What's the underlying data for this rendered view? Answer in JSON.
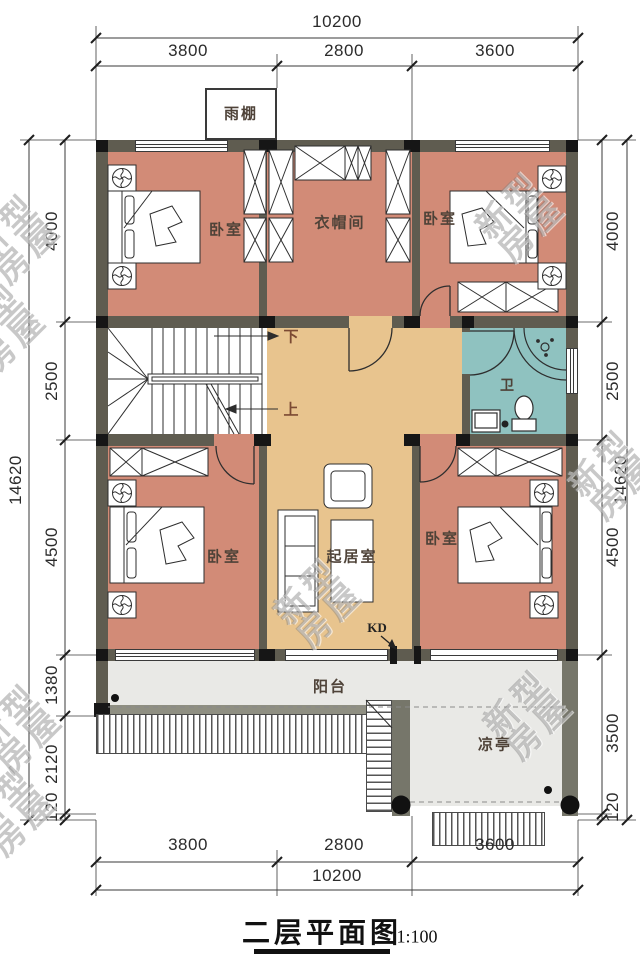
{
  "title": {
    "main": "二层平面图",
    "scale": "1:100"
  },
  "watermark": {
    "line1": "新型",
    "line2": "房屋"
  },
  "labels": {
    "canopy": "雨棚",
    "bedroom_top_left": "卧室",
    "cloakroom": "衣帽间",
    "bedroom_top_right": "卧室",
    "bathroom": "卫",
    "living_room": "起居室",
    "bedroom_bottom_left": "卧室",
    "bedroom_bottom_right": "卧室",
    "balcony": "阳台",
    "pavilion": "凉亭",
    "stair_down": "下",
    "stair_up": "上",
    "kd": "KD"
  },
  "dimensions": {
    "top": {
      "total": "10200",
      "segments": [
        "3800",
        "2800",
        "3600"
      ]
    },
    "bottom": {
      "total": "10200",
      "segments": [
        "3800",
        "2800",
        "3600"
      ]
    },
    "left": {
      "overall": "14620",
      "segments": [
        "4000",
        "2500",
        "4500",
        "1380",
        "2120",
        "120"
      ]
    },
    "right": {
      "overall": "14620",
      "segments": [
        "4000",
        "2500",
        "4500",
        "3500",
        "120"
      ]
    }
  },
  "colors": {
    "room_pink": "#d28b77",
    "hall_tan": "#e8c48e",
    "bath_teal": "#8fc2c0",
    "deck_gray": "#e9e9e6",
    "wall": "#5f5c50"
  }
}
